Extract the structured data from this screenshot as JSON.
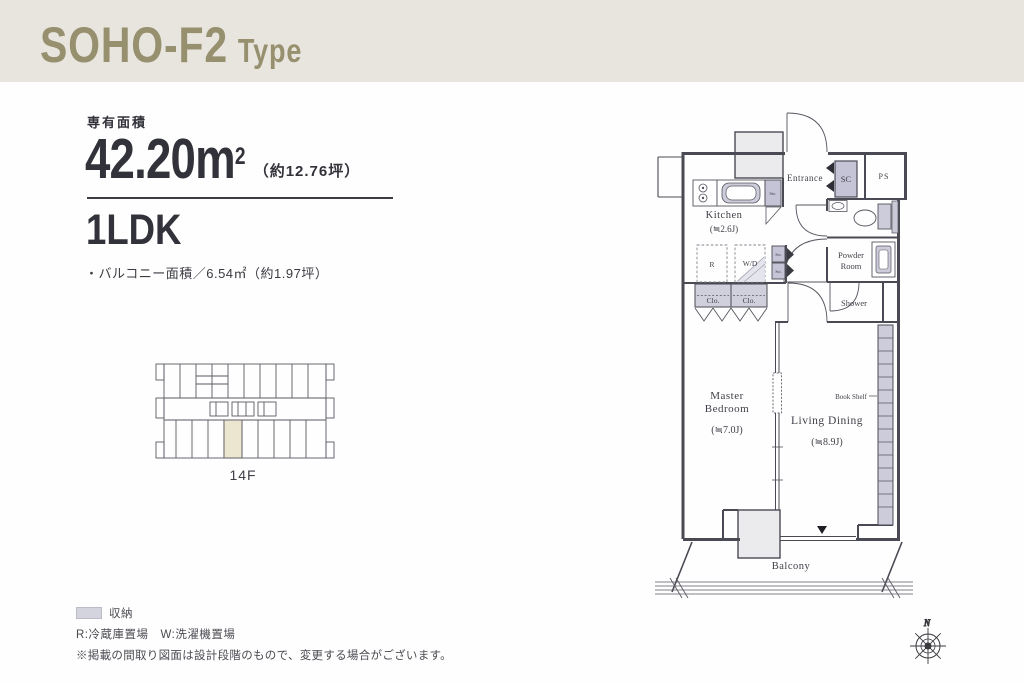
{
  "header": {
    "title": "SOHO-F2",
    "title_suffix": "Type"
  },
  "info": {
    "area_label": "専有面積",
    "area_number": "42.20",
    "area_unit": "m",
    "area_exponent": "2",
    "area_tsubo_note": "（約12.76坪）",
    "plan_type": "1LDK",
    "balcony_note": "・バルコニー面積／6.54㎡（約1.97坪）"
  },
  "keyplan": {
    "floor": "14F"
  },
  "plan": {
    "labels": {
      "entrance": "Entrance",
      "sc": "SC",
      "ps": "PS",
      "kitchen": "Kitchen",
      "kitchen_size": "(≒2.6J)",
      "sto": "Sto.",
      "refrigerator": "R",
      "washer": "W/D",
      "powder_line1": "Powder",
      "powder_line2": "Room",
      "shower": "Shower",
      "closet": "Clo.",
      "master_line1": "Master",
      "master_line2": "Bedroom",
      "master_size": "(≒7.0J)",
      "living": "Living Dining",
      "living_size": "(≒8.9J)",
      "bookshelf": "Book Shelf",
      "balcony": "Balcony",
      "north": "N"
    }
  },
  "legend": {
    "storage_label": "収納",
    "abbreviations": "R:冷蔵庫置場　W:洗濯機置場",
    "disclaimer": "※掲載の間取り図面は設計段階のもので、変更する場合がございます。"
  },
  "colors": {
    "header_bg": "#e8e5de",
    "accent": "#97906f",
    "line": "#4a4a54",
    "fixture_fill": "#ccccdb",
    "column_fill": "#ebebee",
    "highlight_unit": "#ece5cf"
  }
}
